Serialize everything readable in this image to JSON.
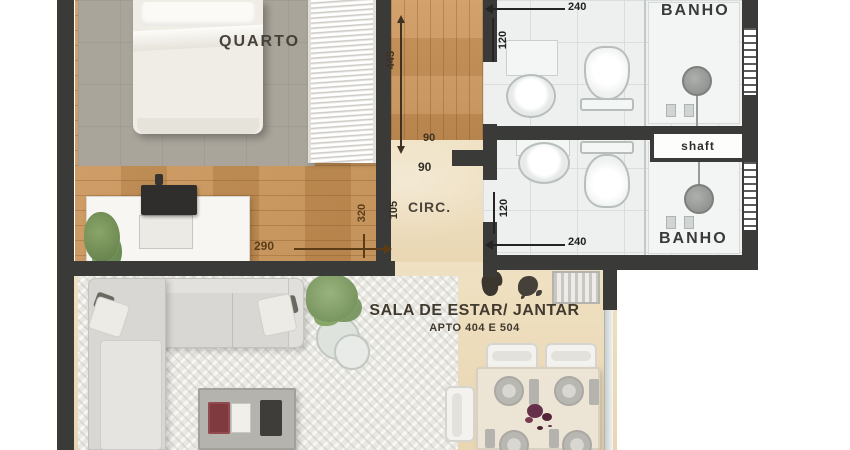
{
  "rooms": {
    "quarto": "QUARTO",
    "banho_top": "BANHO",
    "banho_bottom": "BANHO",
    "shaft": "shaft",
    "circ": "CIRC.",
    "sala_title": "SALA DE ESTAR/ JANTAR",
    "sala_subtitle": "APTO 404 E 504"
  },
  "dimensions": {
    "banho_top_width": "240",
    "banho_top_depth": "120",
    "hall_length": "443",
    "door_top": "90",
    "door_bottom": "90",
    "circ_width": "105",
    "quarto_depth": "320",
    "quarto_width": "290",
    "banho_bottom_depth": "120",
    "banho_bottom_width": "240"
  },
  "icons": {
    "bed": "double-bed-top-view",
    "wardrobe": "closet-shelves",
    "tv_stand": "dresser-with-tv",
    "sofa": "l-shaped-sofa",
    "coffee_table": "coffee-table",
    "dining_table": "dining-table-4-plates",
    "sink": "bathroom-sink",
    "toilet": "toilet",
    "shower": "shower-head",
    "plant": "potted-plant",
    "window": "hatched-window",
    "glass_door": "balcony-glass-door"
  },
  "colors": {
    "wall": "#3a3a38",
    "wood_floor": "#c6925c",
    "beige_floor": "#ecdcbb",
    "tile_floor": "#eef0ef",
    "bedroom_rug": "#aaa59b",
    "flower_accent": "#6b3245",
    "plant_green": "#7d9a66"
  }
}
